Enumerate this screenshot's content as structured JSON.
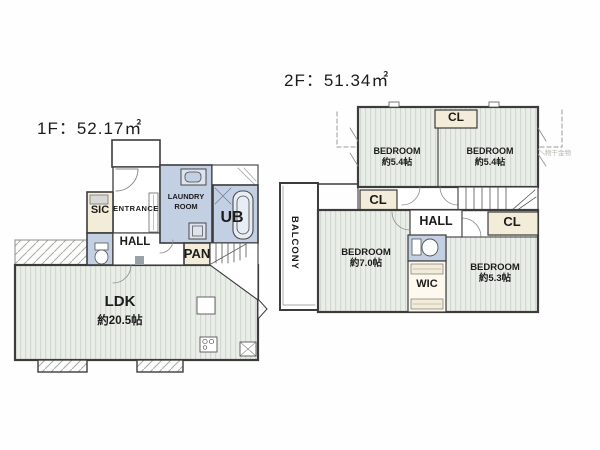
{
  "document_type": "floor-plan",
  "colors": {
    "background": "#fefefe",
    "wet_room_blue": "#c3cfe2",
    "closet_cream": "#f3ecd8",
    "floor_stripe_base": "#eaeee8",
    "floor_stripe_line": "#d2d9d1",
    "wall": "#3c3c3c"
  },
  "floors": [
    {
      "id": "1f",
      "title": "1F：52.17㎡",
      "rooms": {
        "sic": "SIC",
        "entrance": "ENTRANCE",
        "laundry_line1": "LAUNDRY",
        "laundry_line2": "ROOM",
        "ub": "UB",
        "hall": "HALL",
        "pan": "PAN",
        "ldk": "LDK",
        "ldk_size": "約20.5帖"
      }
    },
    {
      "id": "2f",
      "title": "2F：51.34㎡",
      "rooms": {
        "cl_top": "CL",
        "bedroom1": "BEDROOM",
        "bedroom1_size": "約5.4帖",
        "bedroom2": "BEDROOM",
        "bedroom2_size": "約5.4帖",
        "cl_left": "CL",
        "hall": "HALL",
        "cl_right": "CL",
        "balcony": "BALCONY",
        "bedroom3": "BEDROOM",
        "bedroom3_size": "約7.0帖",
        "wic": "WIC",
        "bedroom4": "BEDROOM",
        "bedroom4_size": "約5.3帖",
        "annotation": "物干金物"
      }
    }
  ]
}
